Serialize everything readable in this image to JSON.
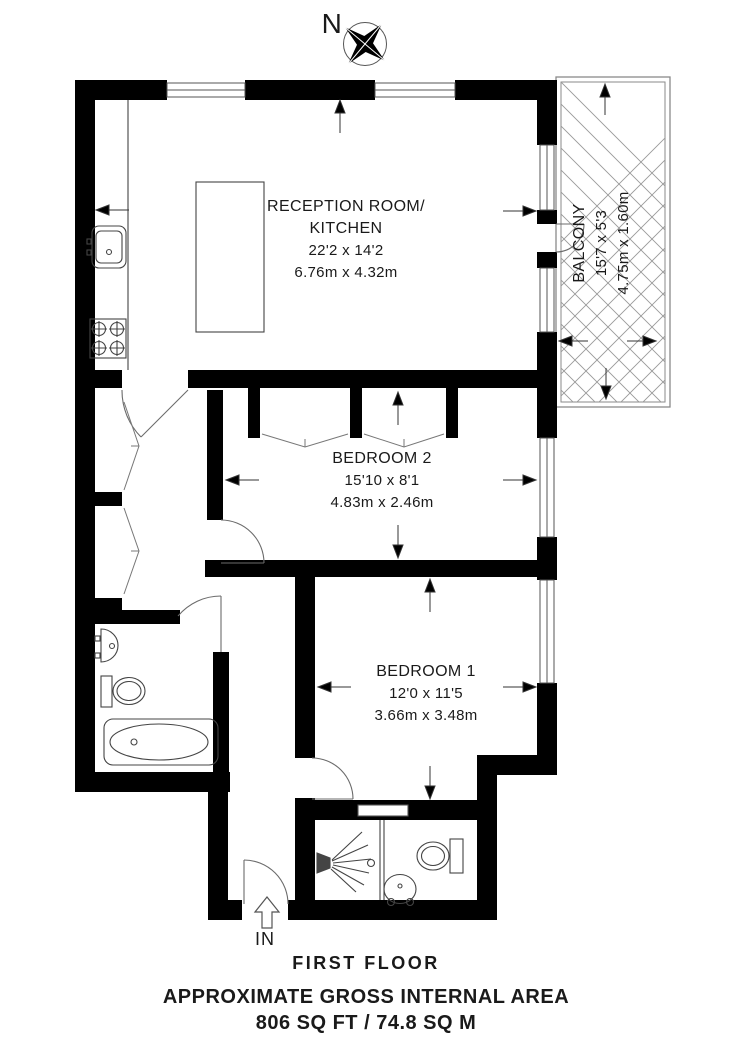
{
  "compass": {
    "label": "N"
  },
  "rooms": {
    "reception": {
      "name_line1": "RECEPTION ROOM/",
      "name_line2": "KITCHEN",
      "imperial": "22'2 x 14'2",
      "metric": "6.76m x 4.32m"
    },
    "balcony": {
      "name": "BALCONY",
      "imperial": "15'7 x 5'3",
      "metric": "4.75m x 1.60m"
    },
    "bedroom2": {
      "name": "BEDROOM 2",
      "imperial": "15'10 x 8'1",
      "metric": "4.83m x 2.46m"
    },
    "bedroom1": {
      "name": "BEDROOM 1",
      "imperial": "12'0 x 11'5",
      "metric": "3.66m x 3.48m"
    }
  },
  "entrance": {
    "label": "IN"
  },
  "footer": {
    "floor": "FIRST FLOOR",
    "area_title": "APPROXIMATE GROSS INTERNAL AREA",
    "area_value": "806 SQ FT / 74.8 SQ M"
  },
  "colors": {
    "wall": "#000000",
    "door_arc": "#6b6b6b",
    "fixture_line": "#444444",
    "window_line": "#555555",
    "balcony_hatch": "#999999",
    "text": "#1a1a1a"
  },
  "icons": {
    "compass": "compass-rose-icon",
    "entrance_arrow": "up-arrow-icon",
    "fixtures": [
      "kitchen-sink-icon",
      "hob-icon",
      "kitchen-island-icon",
      "hall-closet-bifold-icon",
      "wardrobe-bifold-icon",
      "bath-basin-icon",
      "bathroom-toilet-icon",
      "bathtub-icon",
      "shower-icon",
      "shower-room-toilet-icon",
      "shower-room-basin-icon"
    ]
  }
}
